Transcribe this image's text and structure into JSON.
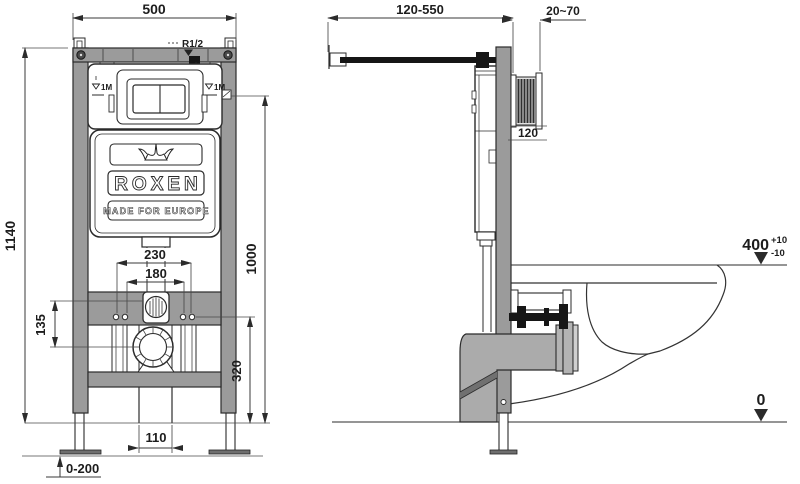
{
  "front_view": {
    "width": "500",
    "height": "1140",
    "level_height": "1000",
    "outer_studs": "230",
    "inner_studs": "180",
    "flush_drain_offset": "135",
    "studs_height": "320",
    "drain_width": "110",
    "legs_range": "0-200",
    "inlet": "R1/2",
    "level_mark": "1M",
    "brand": "ROXEN",
    "tagline": "MADE FOR EUROPE"
  },
  "side_view": {
    "depth_range": "120-550",
    "wall_range": "20~70",
    "opening_height": "120",
    "bowl_level": "400",
    "tol_plus": "+10",
    "tol_minus": "-10",
    "zero": "0"
  },
  "colors": {
    "frame_gray": "#9b9b9b",
    "pipe_gray": "#ababab",
    "line": "#2b2b2b",
    "background": "#ffffff"
  }
}
